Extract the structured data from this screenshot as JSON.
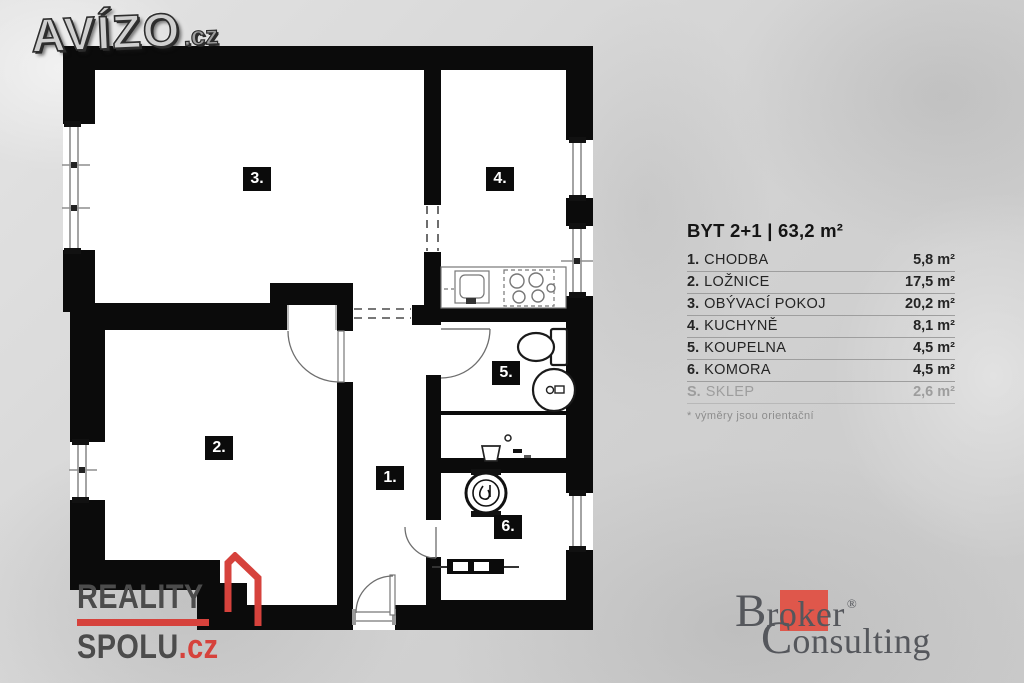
{
  "branding": {
    "avizo": {
      "text": "AVÍZO",
      "tld": ".cz"
    },
    "reality_spolu": {
      "line1": "REALITY",
      "line2": "SPOLU",
      "tld": ".cz",
      "accent_color": "#d6423c"
    },
    "broker": {
      "b": "B",
      "roker": "roker",
      "reg": "®",
      "c": "C",
      "onsulting": "onsulting",
      "accent_color": "#df574b"
    }
  },
  "legend": {
    "title": "BYT 2+1 | 63,2 m²",
    "rows": [
      {
        "num": "1.",
        "name": "CHODBA",
        "area": "5,8 m²"
      },
      {
        "num": "2.",
        "name": "LOŽNICE",
        "area": "17,5 m²"
      },
      {
        "num": "3.",
        "name": "OBÝVACÍ POKOJ",
        "area": "20,2 m²"
      },
      {
        "num": "4.",
        "name": "KUCHYNĚ",
        "area": "8,1 m²"
      },
      {
        "num": "5.",
        "name": "KOUPELNA",
        "area": "4,5 m²"
      },
      {
        "num": "6.",
        "name": "KOMORA",
        "area": "4,5 m²"
      },
      {
        "num": "S.",
        "name": "SKLEP",
        "area": "2,6 m²"
      }
    ],
    "note": "* výměry jsou orientační"
  },
  "plan": {
    "room_labels": [
      {
        "num": "1."
      },
      {
        "num": "2."
      },
      {
        "num": "3."
      },
      {
        "num": "4."
      },
      {
        "num": "5."
      },
      {
        "num": "6."
      }
    ],
    "wall_color": "#0b0b0b",
    "floor_color": "#ffffff"
  }
}
